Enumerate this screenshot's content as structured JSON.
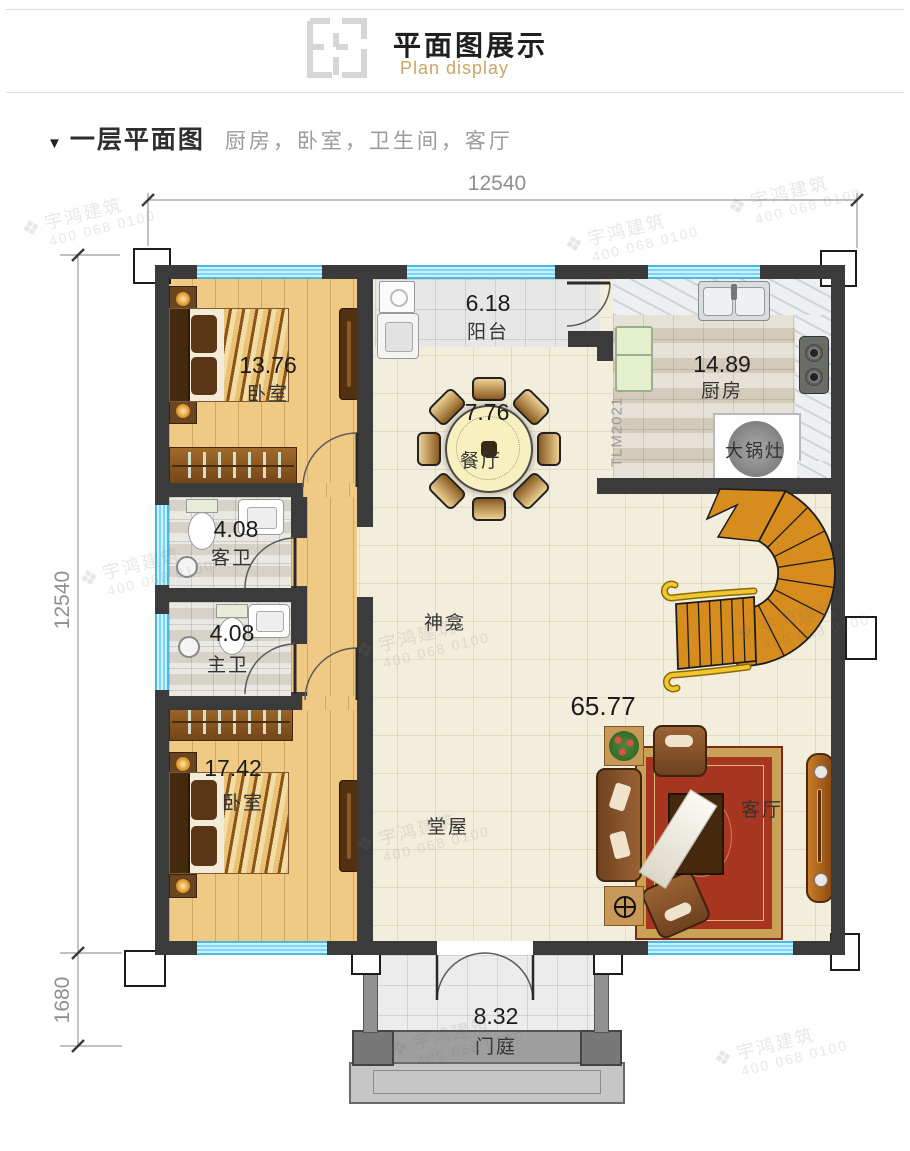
{
  "header": {
    "title": "平面图展示",
    "subtitle": "Plan display"
  },
  "section": {
    "marker": "▼",
    "title": "一层平面图",
    "desc": "厨房，卧室，卫生间，客厅"
  },
  "dims": {
    "top": "12540",
    "left": "12540",
    "left_lower": "1680"
  },
  "rooms": {
    "bedroom1": {
      "area": "13.76",
      "name": "卧室"
    },
    "balcony": {
      "area": "6.18",
      "name": "阳台"
    },
    "kitchen": {
      "area": "14.89",
      "name": "厨房"
    },
    "dining": {
      "area": "7.76",
      "name": "餐厅"
    },
    "guest_bath": {
      "area": "4.08",
      "name": "客卫"
    },
    "master_bath": {
      "area": "4.08",
      "name": "主卫"
    },
    "bedroom2": {
      "area": "17.42",
      "name": "卧室"
    },
    "hall": {
      "area": "65.77",
      "name": "堂屋"
    },
    "shrine": {
      "name": "神龛"
    },
    "living": {
      "name": "客厅"
    },
    "porch": {
      "area": "8.32",
      "name": "门庭"
    },
    "big_stove": {
      "name": "大锅灶"
    }
  },
  "annotations": {
    "model": "TLM2021"
  },
  "watermark": {
    "logo": "❖",
    "text": "宇鸿建筑",
    "phone": "400 068 0100"
  },
  "colors": {
    "accent": "#c8a668",
    "wall": "#3b3b3b",
    "window": "#7fd6f4",
    "stairs": "#d78c1e",
    "rug": "#a8351f",
    "wood_floor": "#f0ca84"
  }
}
